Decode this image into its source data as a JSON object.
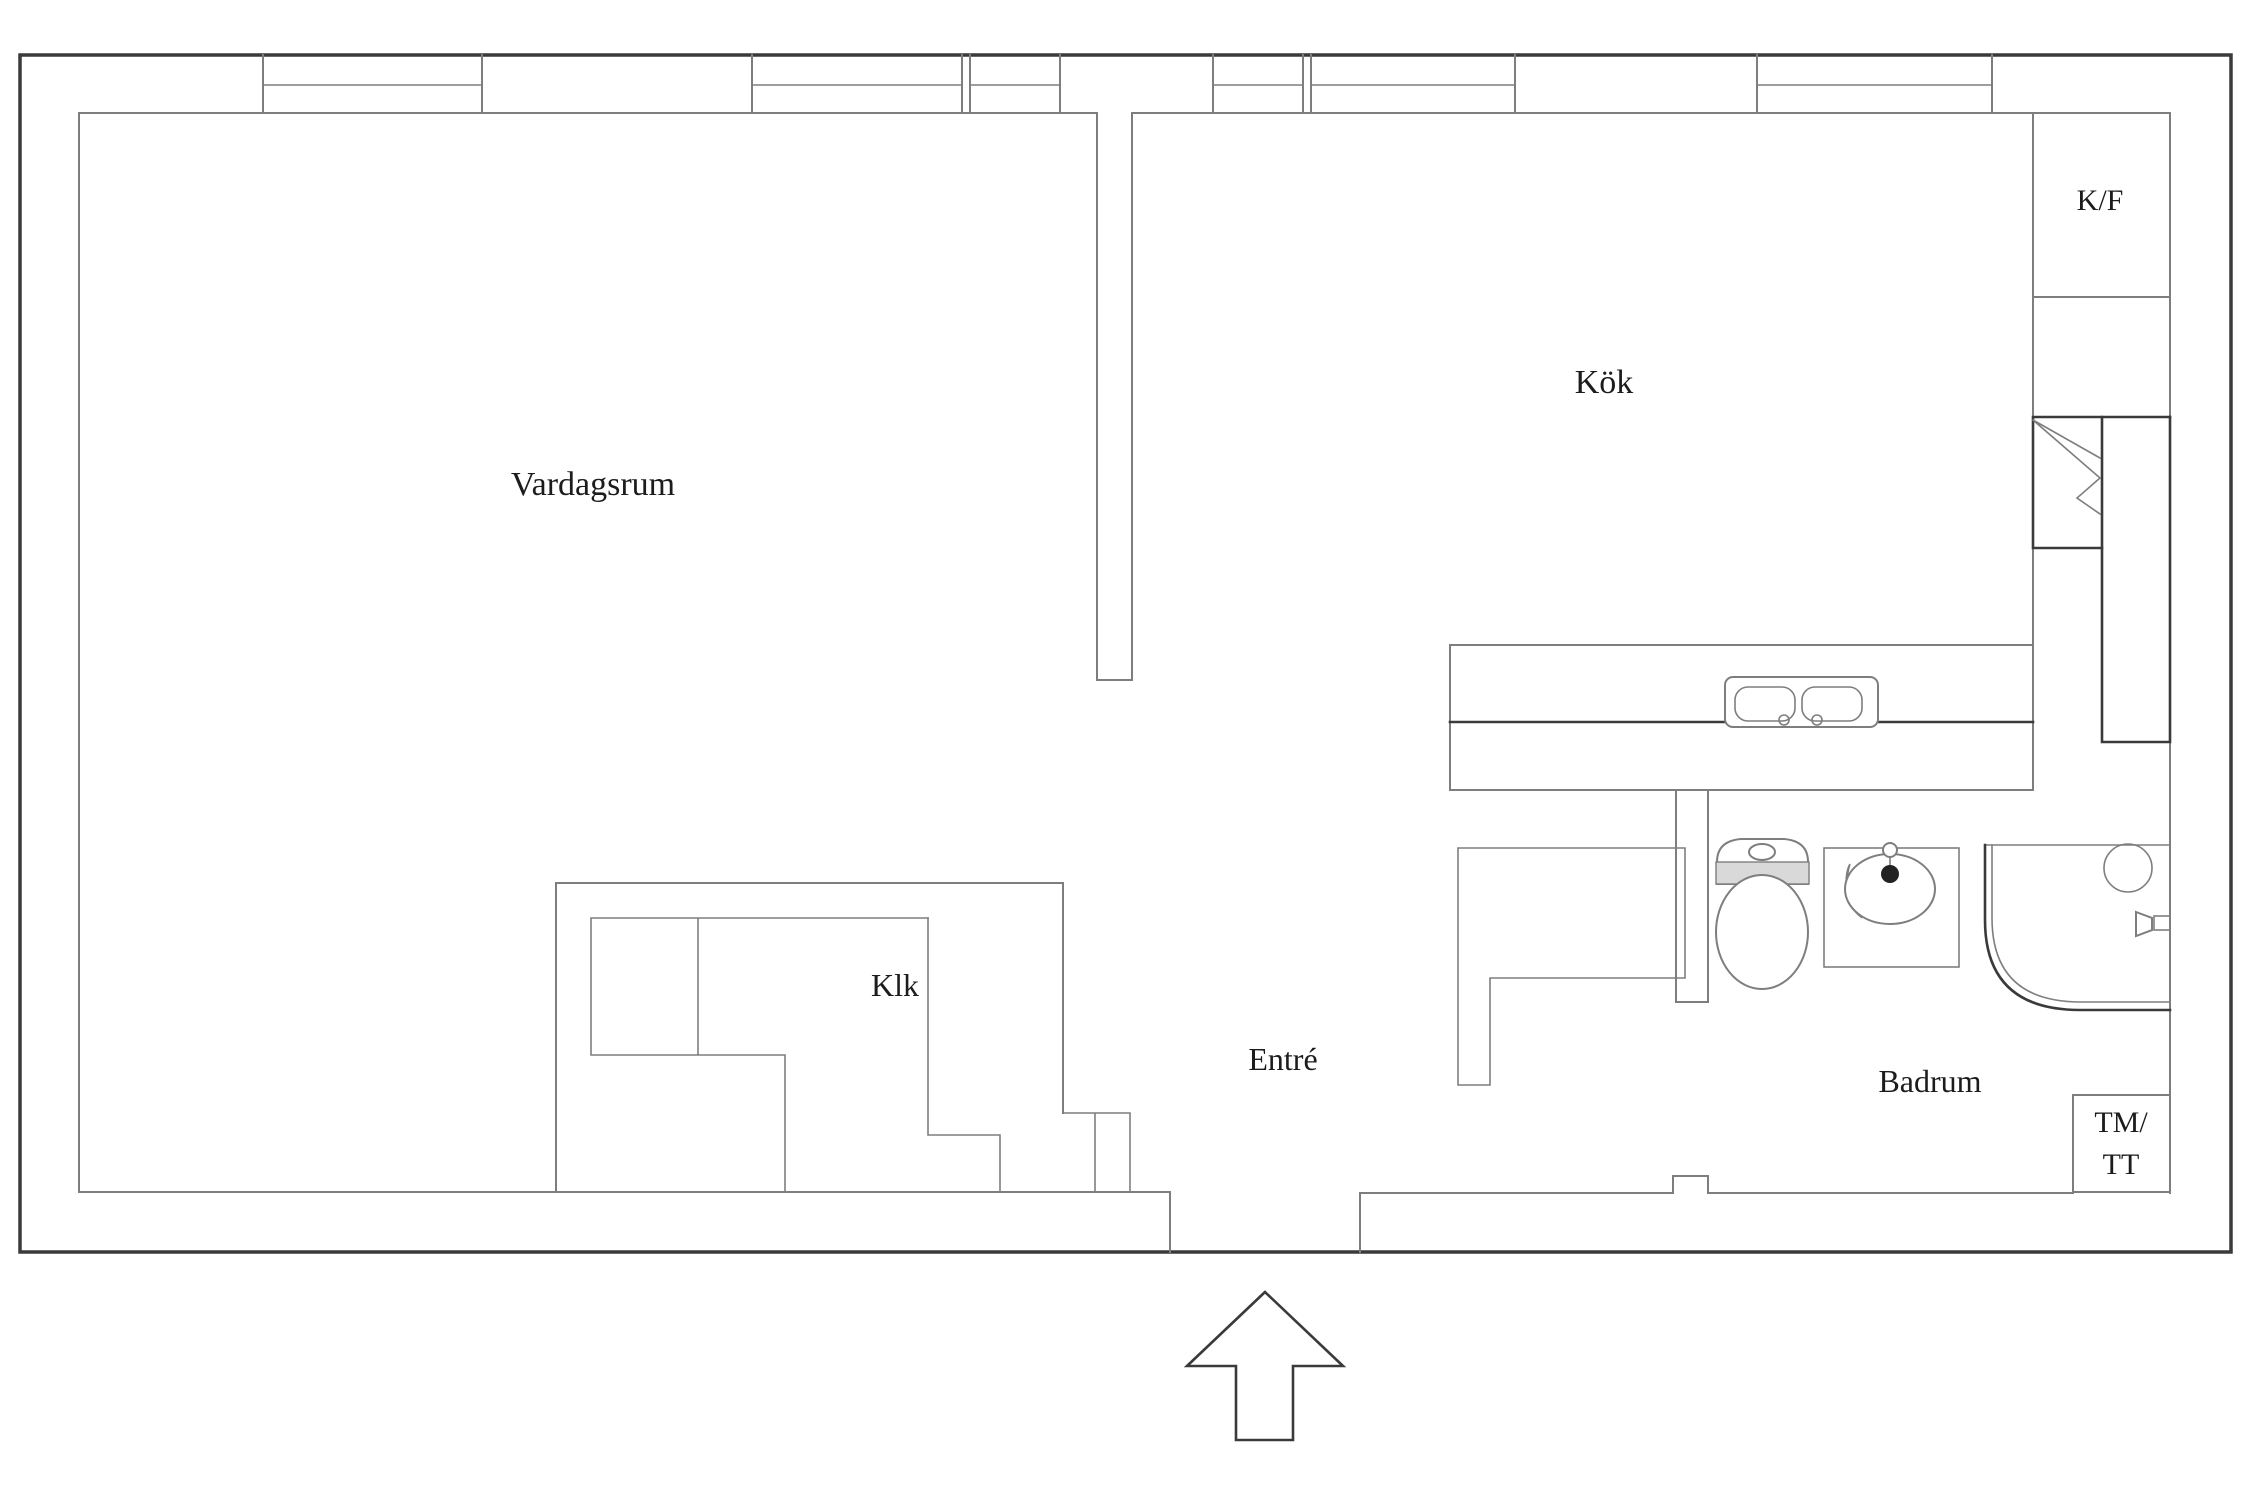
{
  "rooms": {
    "living_room": "Vardagsrum",
    "kitchen": "Kök",
    "closet": "Klk",
    "entrance": "Entré",
    "bathroom": "Badrum"
  },
  "appliances": {
    "fridge_freezer": "K/F",
    "washer_dryer_line1": "TM/",
    "washer_dryer_line2": "TT"
  },
  "icons": [
    "entrance-arrow-icon",
    "kitchen-sink-icon",
    "toilet-icon",
    "washbasin-icon",
    "bathtub-icon",
    "cabinet-folding-door-icon"
  ],
  "colors": {
    "background": "#ffffff",
    "exterior_wall": "#3a3a3a",
    "interior_line": "#7e7e7e",
    "text": "#1c1c1c",
    "shading": "#d9d9d9"
  }
}
